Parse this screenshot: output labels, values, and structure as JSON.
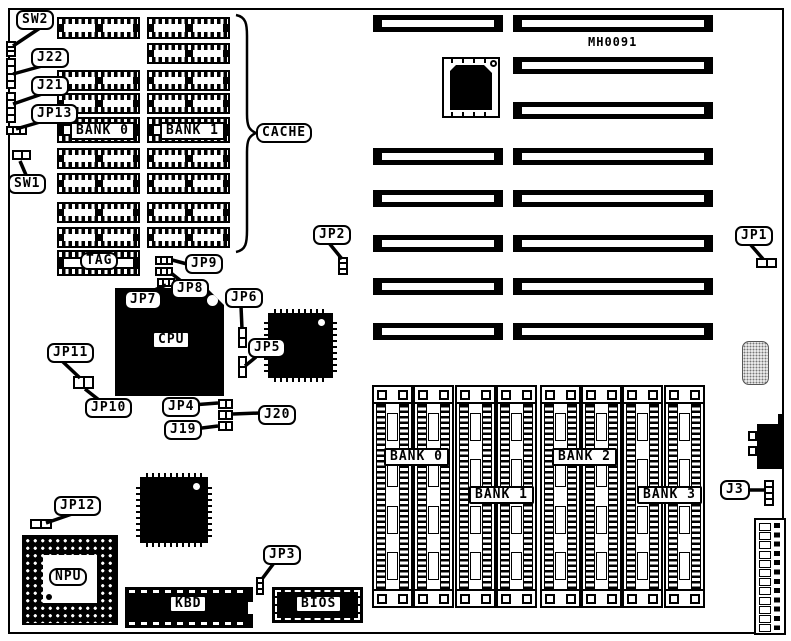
{
  "board": {
    "id": "MH0091"
  },
  "colors": {
    "ink": "#000000",
    "paper": "#ffffff"
  },
  "cache": {
    "label": "CACHE",
    "bank0": "BANK 0",
    "bank1": "BANK 1",
    "tag": "TAG"
  },
  "chips": {
    "cpu": "CPU",
    "npu": "NPU",
    "kbd": "KBD",
    "bios": "BIOS"
  },
  "memory": {
    "bank0": "BANK 0",
    "bank1": "BANK 1",
    "bank2": "BANK 2",
    "bank3": "BANK 3"
  },
  "callouts": {
    "sw2": "SW2",
    "j22": "J22",
    "j21": "J21",
    "jp13": "JP13",
    "sw1": "SW1",
    "jp9": "JP9",
    "jp8": "JP8",
    "jp7": "JP7",
    "jp6": "JP6",
    "jp5": "JP5",
    "jp11": "JP11",
    "jp10": "JP10",
    "jp4": "JP4",
    "j20": "J20",
    "j19": "J19",
    "jp12": "JP12",
    "jp3": "JP3",
    "jp2": "JP2",
    "jp1": "JP1",
    "j3": "J3"
  }
}
